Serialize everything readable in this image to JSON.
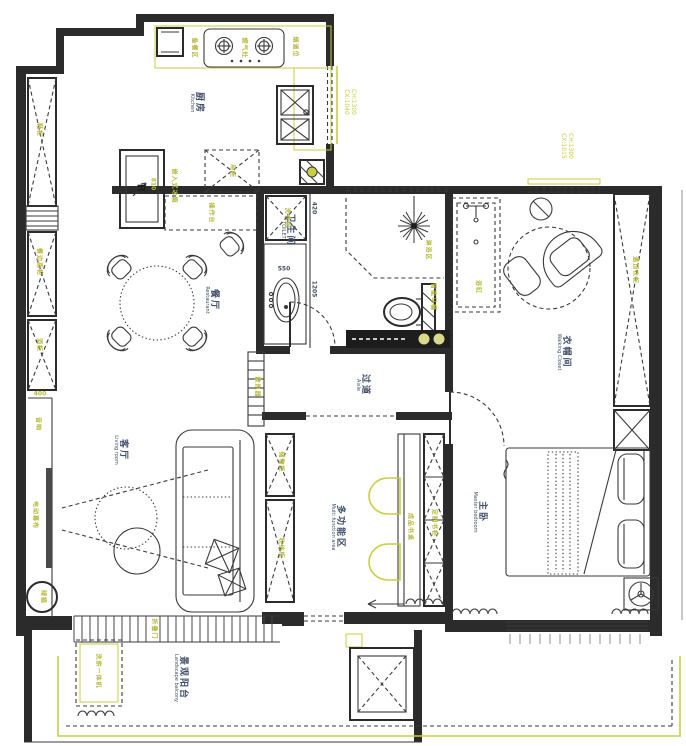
{
  "colors": {
    "annotation": "#b6b93a",
    "room_label": "#43506b",
    "wall": "#2b2b2b",
    "accent_yellow": "#cace42"
  },
  "rooms": {
    "kitchen": {
      "zh": "厨房",
      "en": "Kitchen"
    },
    "dining": {
      "zh": "餐厅",
      "en": "Restaurant"
    },
    "living": {
      "zh": "客厅",
      "en": "Living room"
    },
    "toilet": {
      "zh": "卫生间",
      "en": "TOILET"
    },
    "aisle": {
      "zh": "过道",
      "en": "Aisle"
    },
    "multi": {
      "zh": "多功能区",
      "en": "Multi function area"
    },
    "master": {
      "zh": "主卧",
      "en": "Master bedroom"
    },
    "closet": {
      "zh": "衣帽间",
      "en": "Walking Closet"
    },
    "balcony": {
      "zh": "景观阳台",
      "en": "Landscape balcony"
    }
  },
  "annotations": {
    "shoe_cabinet": "鞋柜",
    "sideboard": "餐边高柜",
    "wine_cabinet": "酒柜",
    "speaker": "音响",
    "projection_screen": "电动幕布",
    "plant": "绿植",
    "prep_area": "备餐区",
    "gas_stove": "燃气灶",
    "flue": "烟道位",
    "fridge": "嵌入式冰箱",
    "fridge_mark": "R",
    "hanging_cabinet": "吊柜",
    "west_counter": "操作台",
    "washer": "洗衣机",
    "shower_area": "淋浴区",
    "smart_toilet": "智能马桶",
    "bathtub": "浴缸",
    "hall_radiator": "散热器",
    "tall_wardrobe": "通顶衣柜",
    "multi_cabinet_1": "储物柜",
    "multi_cabinet_2": "收纳柜",
    "desk": "成品书桌",
    "bookcase": "定制书柜",
    "folding_door": "折叠门",
    "washer_dryer": "洗烘一体机"
  },
  "dimensions": {
    "left_400": "400",
    "fridge_810": "810",
    "bath_420": "420",
    "bath_550": "550",
    "bath_1205": "1205"
  },
  "windows": {
    "kitchen_ch": "CH:1300",
    "kitchen_cx": "CX:1040",
    "closet_ch": "CH:1300",
    "closet_cx": "CX:1015"
  }
}
